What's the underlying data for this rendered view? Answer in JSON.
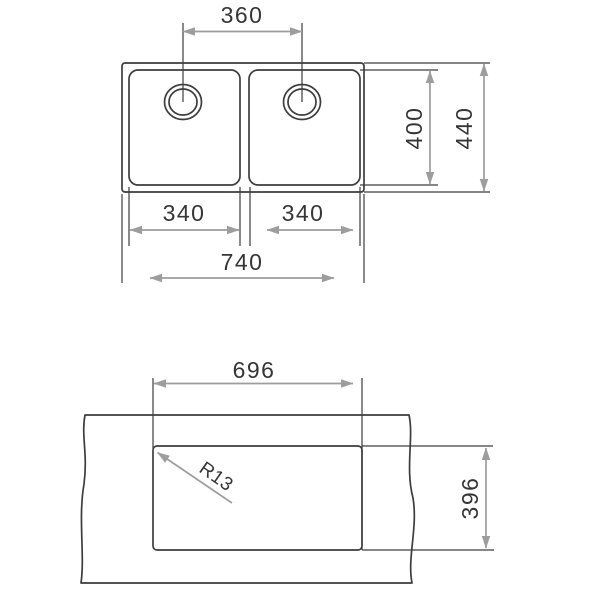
{
  "colors": {
    "background": "#ffffff",
    "outline": "#3d3d3d",
    "dimension_arrow": "#9d9d9d",
    "dimension_text": "#353535"
  },
  "top_view": {
    "drain_spacing_label": "360",
    "inner_depth_label": "400",
    "overall_depth_label": "440",
    "left_bowl_width_label": "340",
    "right_bowl_width_label": "340",
    "overall_width_label": "740"
  },
  "cutout_view": {
    "width_label": "696",
    "depth_label": "396",
    "corner_radius_label": "R13"
  }
}
